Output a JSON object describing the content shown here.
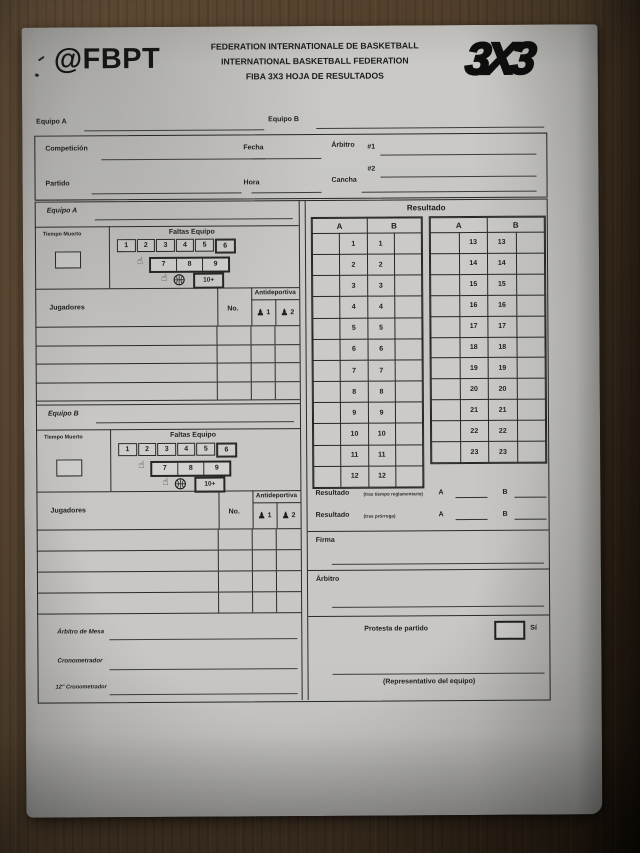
{
  "header": {
    "account": "@FBPT",
    "federation_lines": [
      "FEDERATION INTERNATIONALE DE BASKETBALL",
      "INTERNATIONAL BASKETBALL FEDERATION",
      "FIBA 3X3 HOJA DE RESULTADOS"
    ],
    "logo_3x3": "3X3"
  },
  "top": {
    "equipo_a": "Equipo A",
    "equipo_b": "Equipo B"
  },
  "info": {
    "competicion": "Competición",
    "fecha": "Fecha",
    "arbitro": "Árbitro",
    "ref1": "#1",
    "ref2": "#2",
    "partido": "Partido",
    "hora": "Hora",
    "cancha": "Cancha"
  },
  "faltas": {
    "title": "Faltas Equipo",
    "row1": [
      "1",
      "2",
      "3",
      "4",
      "5",
      "6"
    ],
    "row2": [
      "7",
      "8",
      "9"
    ],
    "row3": "10+"
  },
  "teams": {
    "a": {
      "title": "Equipo A",
      "tiempo_muerto": "Tiempo Muerto",
      "jugadores": "Jugadores",
      "no": "No.",
      "antideportiva": "Antideportiva",
      "anti1": "1",
      "anti2": "2"
    },
    "b": {
      "title": "Equipo B",
      "tiempo_muerto": "Tiempo Muerto",
      "jugadores": "Jugadores",
      "no": "No.",
      "antideportiva": "Antideportiva",
      "anti1": "1",
      "anti2": "2"
    }
  },
  "score": {
    "title": "Resultado",
    "col_a": "A",
    "col_b": "B",
    "table1": [
      "1",
      "2",
      "3",
      "4",
      "5",
      "6",
      "7",
      "8",
      "9",
      "10",
      "11",
      "12"
    ],
    "table2": [
      "13",
      "14",
      "15",
      "16",
      "17",
      "18",
      "19",
      "20",
      "21",
      "22",
      "23"
    ]
  },
  "results": {
    "label": "Resultado",
    "note_regulation": "(tras tiempo reglamentario)",
    "note_overtime": "(tras prórroga)",
    "a": "A",
    "b": "B"
  },
  "signatures": {
    "firma": "Firma",
    "arbitro": "Árbitro"
  },
  "officials": {
    "mesa": "Árbitro de Mesa",
    "crono": "Cronometrador",
    "crono12": "12\" Cronometrador"
  },
  "protesta": {
    "label": "Protesta de partido",
    "si": "Sí",
    "representative": "(Representativo del equipo)"
  },
  "icons": {
    "free_throw_hand": "☝",
    "unsportsmanlike": "♟"
  },
  "colors": {
    "paper": "#c8c7c3",
    "ink": "#222222",
    "wood": "#5d4933"
  }
}
